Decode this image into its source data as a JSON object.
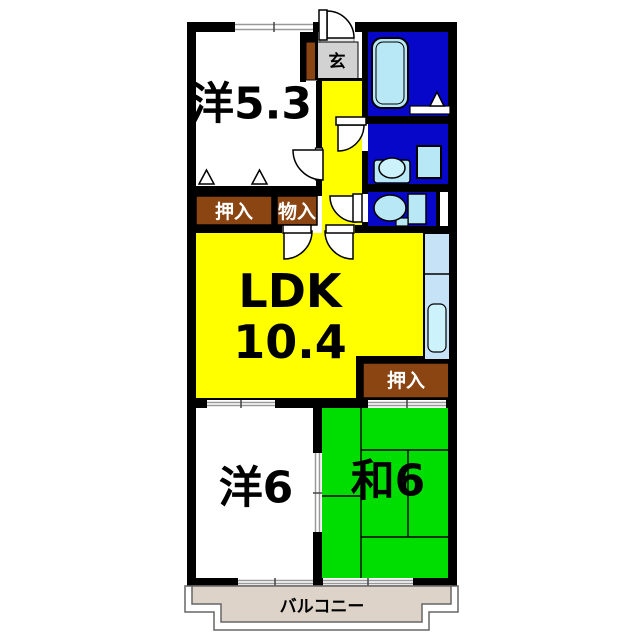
{
  "floor_plan": {
    "rooms": {
      "western_53": {
        "label": "洋5.3"
      },
      "entrance": {
        "label": "玄"
      },
      "closet_top": {
        "label": "押入"
      },
      "storage": {
        "label": "物入"
      },
      "ldk": {
        "label": "LDK",
        "area": "10.4"
      },
      "closet_right": {
        "label": "押入"
      },
      "western_6": {
        "label": "洋6"
      },
      "japanese_6": {
        "label": "和6"
      },
      "balcony": {
        "label": "バルコニー"
      }
    },
    "colors": {
      "wall": "#000000",
      "ldk_yellow": "#ffff00",
      "tatami_green": "#00dd00",
      "wet_blue": "#0707c9",
      "closet_brown": "#8b4513",
      "fixture_blue": "#b8e8f5",
      "sink_blue": "#ccf2fb",
      "counter_blue": "#c5e2f7",
      "entrance_gray": "#d2d2d2",
      "step_gray": "#e9e9e9",
      "balcony_beige": "#ddd3c8",
      "window_gray": "#999999"
    }
  }
}
